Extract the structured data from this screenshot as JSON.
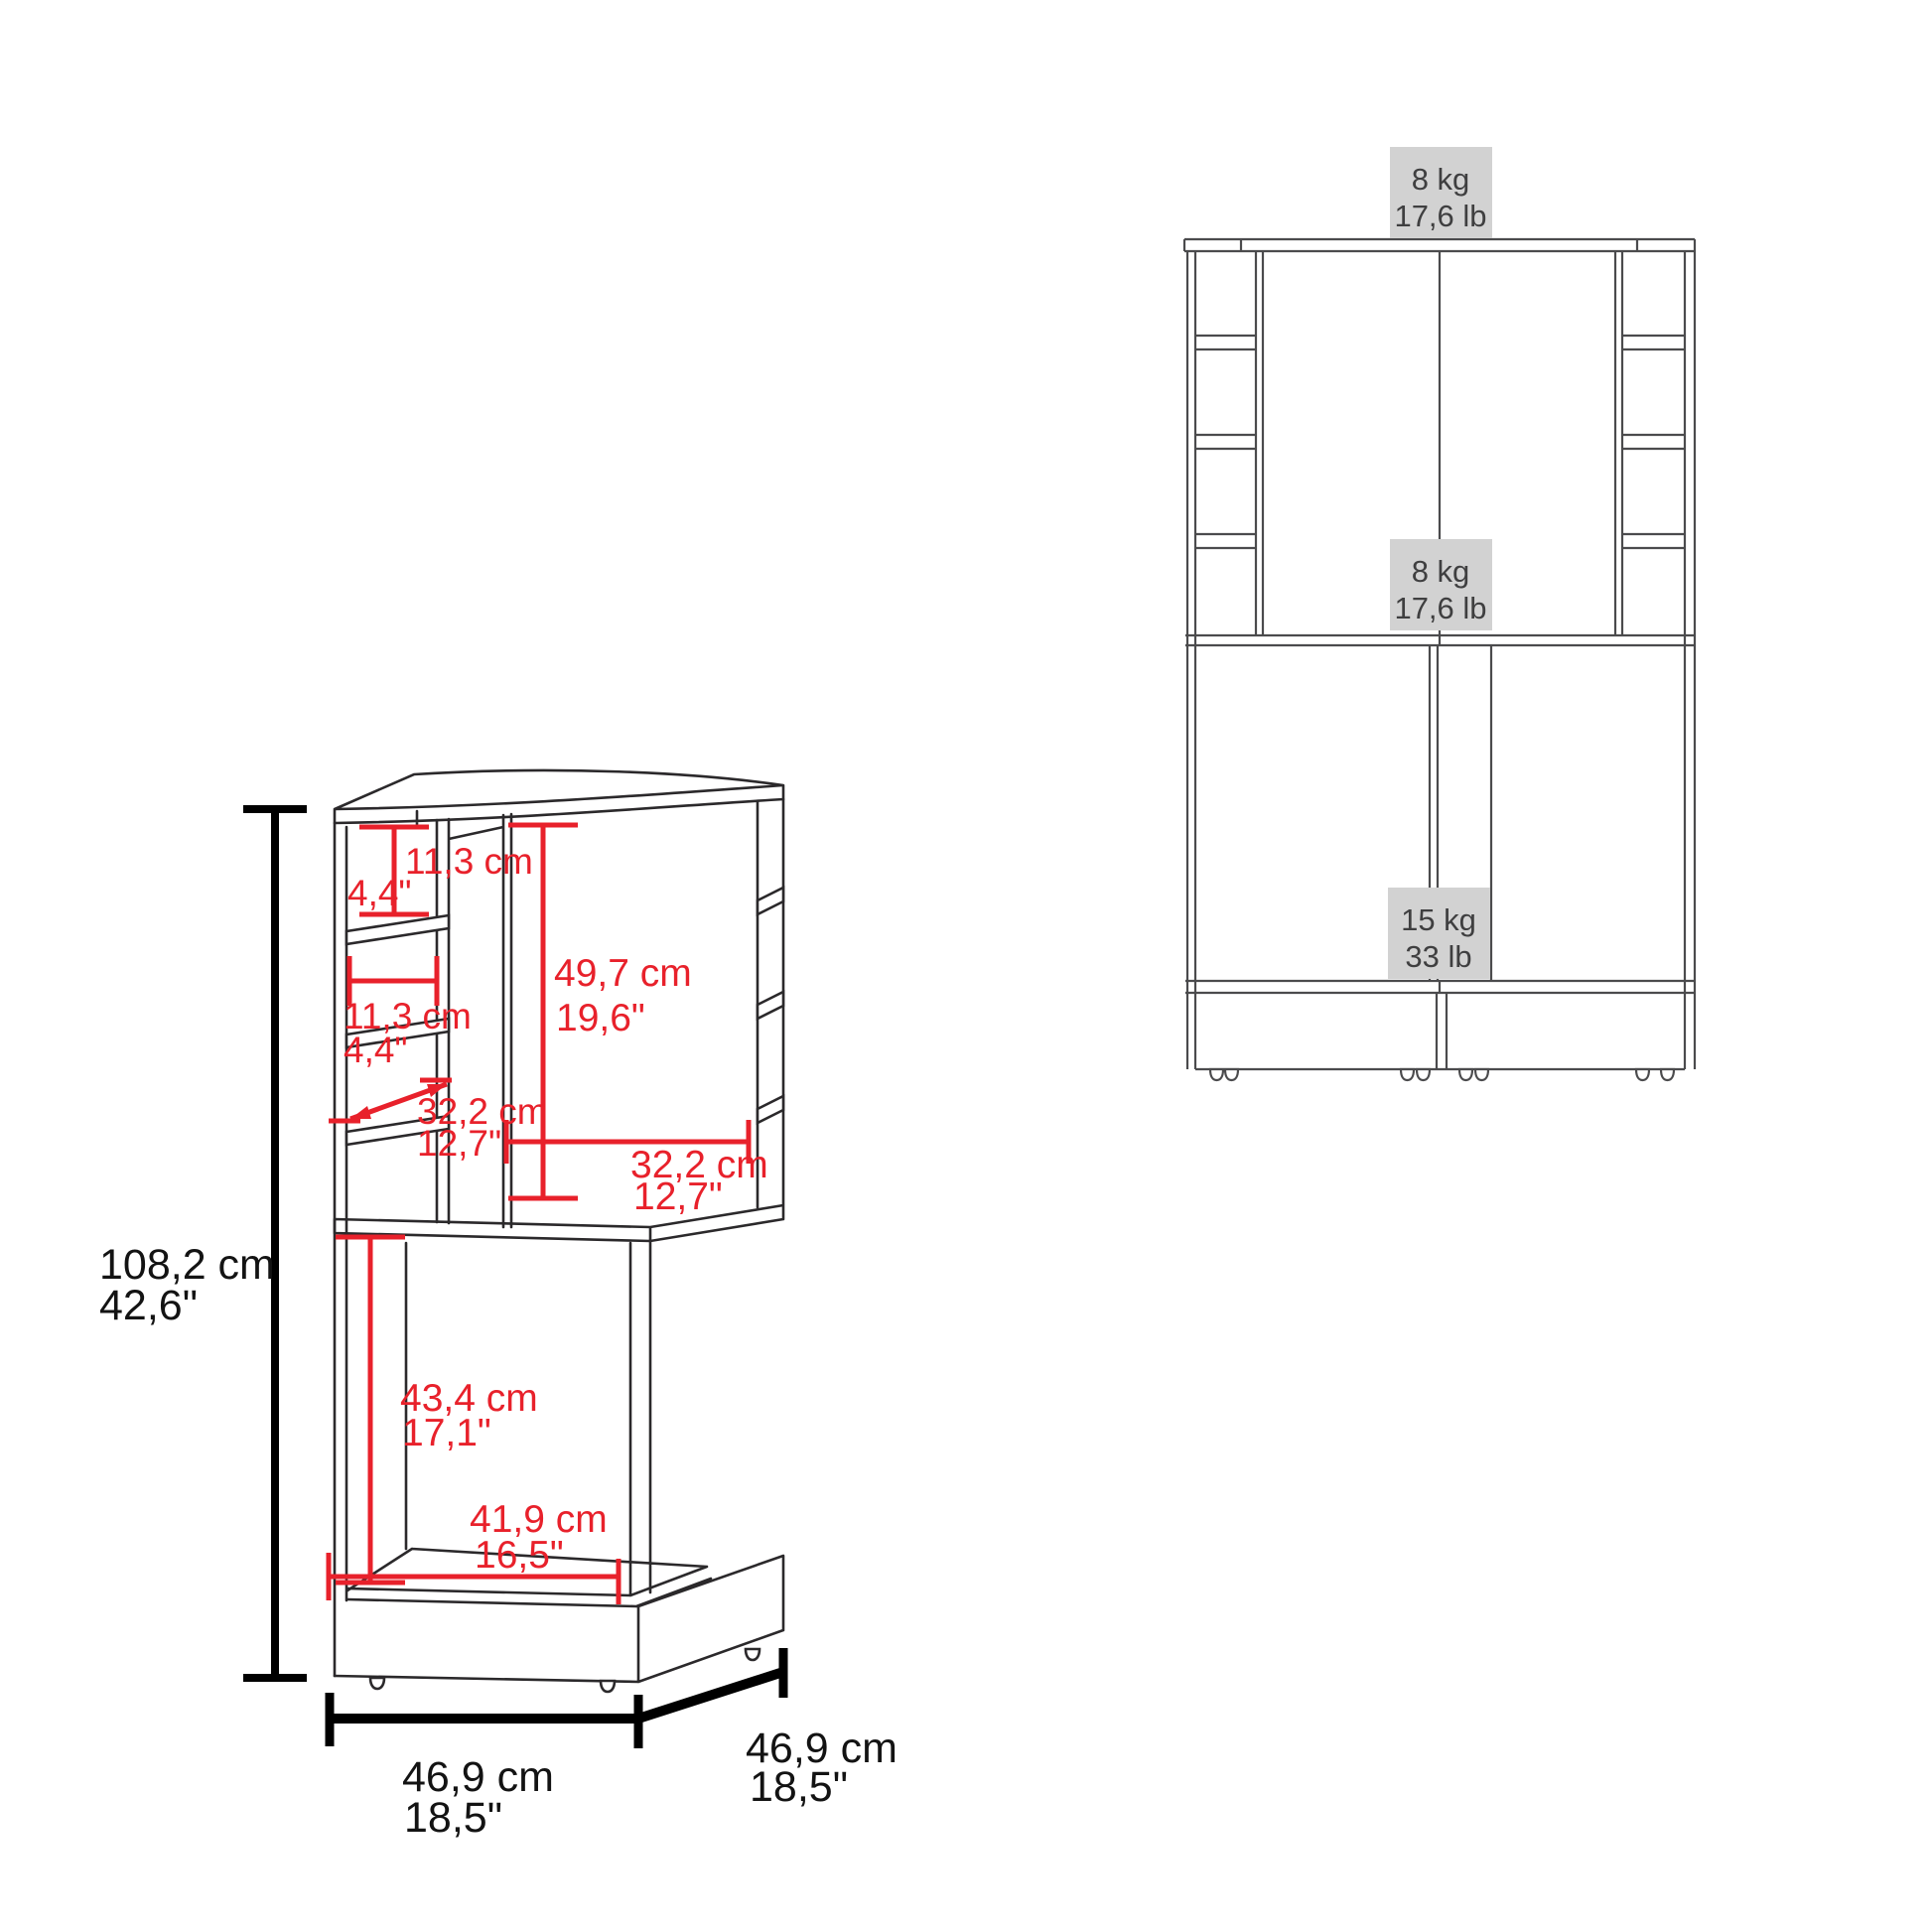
{
  "colors": {
    "dimension_red": "#e8212b",
    "drawing_line_dark": "#2b292b",
    "front_view_line": "#4b4b4d",
    "weight_box_bg": "#d2d2d2",
    "weight_text": "#3f3f40",
    "black_dimension": "#000000"
  },
  "left_diagram": {
    "description": "corner-bar-cabinet-perspective-view",
    "dims_red": {
      "cubby_height": {
        "cm": "11,3 cm",
        "inch": "4,4\""
      },
      "open_height": {
        "cm": "49,7 cm",
        "inch": "19,6\""
      },
      "cubby_width": {
        "cm": "11,3 cm",
        "inch": "4,4\""
      },
      "shelf_depth": {
        "cm": "32,2 cm",
        "inch": "12,7\""
      },
      "open_width": {
        "cm": "32,2 cm",
        "inch": "12,7\""
      },
      "lower_height": {
        "cm": "43,4 cm",
        "inch": "17,1\""
      },
      "base_width": {
        "cm": "41,9 cm",
        "inch": "16,5\""
      }
    },
    "dims_black": {
      "height": {
        "cm": "108,2 cm",
        "inch": "42,6\""
      },
      "width": {
        "cm": "46,9 cm",
        "inch": "18,5\""
      },
      "depth": {
        "cm": "46,9 cm",
        "inch": "18,5\""
      }
    }
  },
  "right_diagram": {
    "description": "front-view-load-capacity",
    "weight_top": {
      "kg": "8 kg",
      "lb": "17,6 lb"
    },
    "weight_middle": {
      "kg": "8 kg",
      "lb": "17,6 lb"
    },
    "weight_bottom": {
      "kg": "15 kg",
      "lb": "33 lb"
    }
  }
}
